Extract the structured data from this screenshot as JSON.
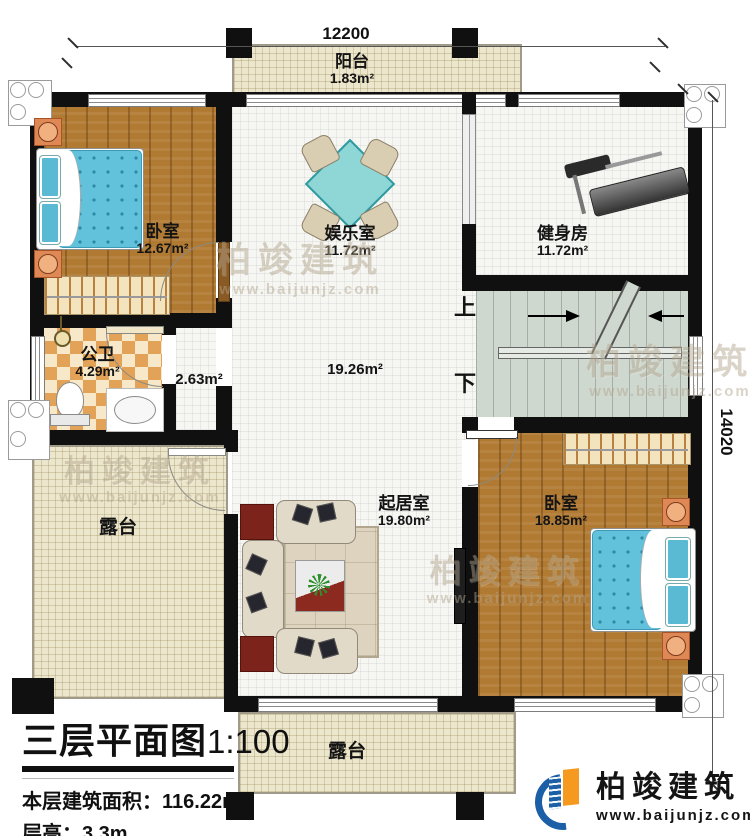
{
  "title": {
    "main": "三层平面图",
    "scale": "1:100"
  },
  "info": {
    "area_label": "本层建筑面积：",
    "area_value": "116.22m²",
    "floor_height_label": "层高：",
    "floor_height_value": "3.3m"
  },
  "dimensions": {
    "top_width": "12200",
    "right_height": "14020"
  },
  "stairs": {
    "up_label": "上",
    "down_label": "下"
  },
  "rooms": {
    "balcony": {
      "name": "阳台",
      "area": "1.83m²"
    },
    "bedroom_top_left": {
      "name": "卧室",
      "area": "12.67m²"
    },
    "entertainment": {
      "name": "娱乐室",
      "area": "11.72m²"
    },
    "gym": {
      "name": "健身房",
      "area": "11.72m²"
    },
    "bathroom": {
      "name": "公卫",
      "area": "4.29m²"
    },
    "corridor": {
      "area": "2.63m²"
    },
    "hall": {
      "area": "19.26m²"
    },
    "living": {
      "name": "起居室",
      "area": "19.80m²"
    },
    "bedroom_bottom_right": {
      "name": "卧室",
      "area": "18.85m²"
    },
    "terrace_left": {
      "name": "露台"
    },
    "terrace_bottom": {
      "name": "露台"
    }
  },
  "watermark": {
    "brand": "柏竣建筑",
    "url": "www.baijunjz.com"
  },
  "logo": {
    "brand": "柏竣建筑",
    "url": "www.baijunjz.com"
  },
  "colors": {
    "wall": "#101010",
    "wood_floor": "#b07a33",
    "tile_cream": "#ece6cd",
    "tile_white": "#f6f6f3",
    "stair": "#cfd8cf",
    "mattress_blue": "#62c2dc",
    "nightstand_orange": "#dd8855",
    "logo_blue": "#1b5fa6",
    "logo_orange": "#f59a1e"
  }
}
